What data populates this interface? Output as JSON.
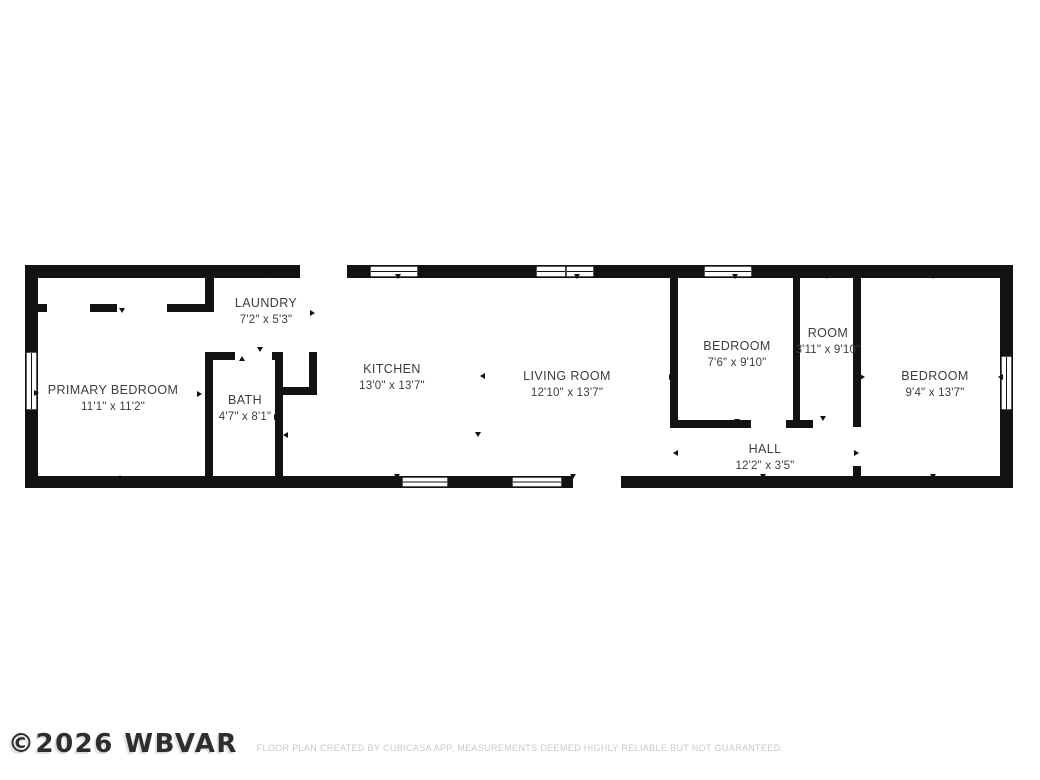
{
  "floorplan": {
    "rooms": [
      {
        "name": "PRIMARY BEDROOM",
        "dims": "11'1\" x 11'2\""
      },
      {
        "name": "LAUNDRY",
        "dims": "7'2\" x 5'3\""
      },
      {
        "name": "BATH",
        "dims": "4'7\" x 8'1\""
      },
      {
        "name": "KITCHEN",
        "dims": "13'0\" x 13'7\""
      },
      {
        "name": "LIVING ROOM",
        "dims": "12'10\" x 13'7\""
      },
      {
        "name": "BEDROOM",
        "dims": "7'6\" x 9'10\""
      },
      {
        "name": "ROOM",
        "dims": "3'11\" x 9'10\""
      },
      {
        "name": "BEDROOM",
        "dims": "9'4\" x 13'7\""
      },
      {
        "name": "HALL",
        "dims": "12'2\" x 3'5\""
      }
    ]
  },
  "footer": {
    "watermark": "©2026 WBVAR",
    "disclaimer": "FLOOR PLAN CREATED BY CUBICASA APP, MEASUREMENTS DEEMED HIGHLY RELIABLE BUT NOT GUARANTEED."
  },
  "colors": {
    "wall": "#121212",
    "room_text": "#3d3d3d",
    "watermark": "#2e2e2e",
    "disclaimer": "#c9c9c9"
  }
}
